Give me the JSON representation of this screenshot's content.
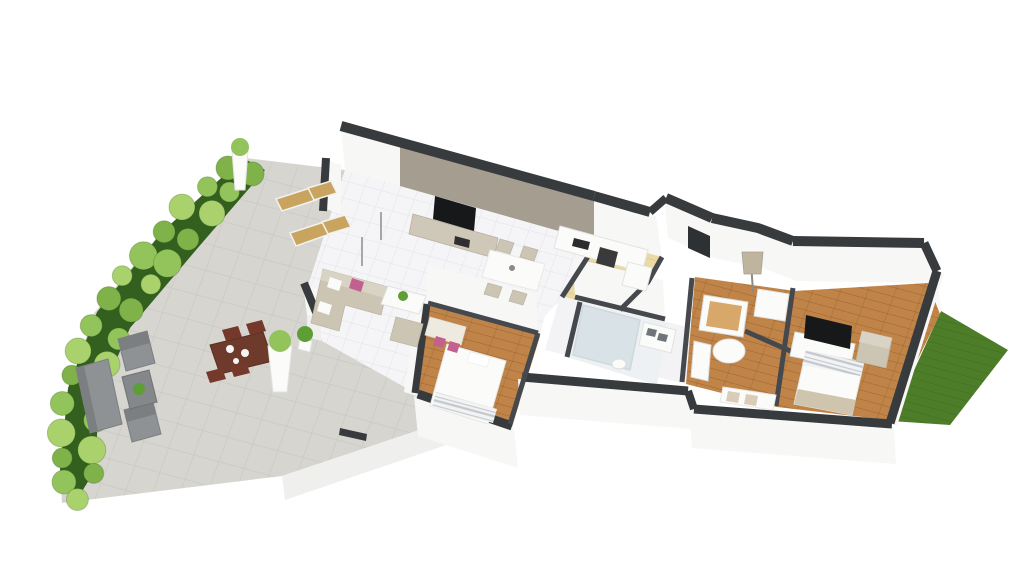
{
  "scene": {
    "title": "3D isometric floor plan rendering",
    "view": "axonometric top-down",
    "background": "#ffffff"
  },
  "colors": {
    "background": "#ffffff",
    "wall_cap": "#383b3e",
    "wall_cap_inner": "#45484c",
    "wall_face": "#f7f7f6",
    "edge_face": "#efefed",
    "accent_wall": "#a59d90",
    "console_taupe": "#cfc8b8",
    "tile_floor": "#f5f5f7",
    "tile_line": "#e3e3e9",
    "paving": "#d7d5d0",
    "paving_line": "#c8c6c1",
    "wood_floor": "#c08448",
    "wood_floor_light": "#ead9a4",
    "floor_hall": "#f3f3f5",
    "floor_bath": "#eef1f3",
    "hedge_grass": "#33601f",
    "bush_green_1": "#7fb249",
    "bush_green_2": "#93c35b",
    "bush_green_3": "#a9d16c",
    "lawn": "#4d7d28",
    "plant_green": "#5d9e35",
    "sofa_beige": "#cdc5b4",
    "sofa_back": "#d9d3c5",
    "pillow_pink": "#c2618f",
    "furniture_white": "#fbfbfa",
    "furniture_stroke": "#e2e2e0",
    "outdoor_gray": "#8f9295",
    "outdoor_gray_dark": "#7c7f82",
    "outdoor_table_brown": "#6e3a2b",
    "outdoor_chair_brown": "#74392a",
    "lounger_wood": "#c9a45f",
    "tv_black": "#17181a",
    "appliance_dark": "#3a3a3c",
    "crib_wood": "#d8a86a",
    "glass": "#b9cdd6",
    "stripe_gray": "#c4c8cd",
    "pot_dark": "#3b3b39"
  },
  "rooms": [
    {
      "id": "living-room",
      "label": "Living room",
      "floor": "white-tile",
      "furniture": [
        "corner-sofa",
        "pink-cushions",
        "coffee-table",
        "potted-plant",
        "tv-accent-wall",
        "flat-tv",
        "media-console",
        "dining-table",
        "dining-chairs"
      ]
    },
    {
      "id": "kitchen",
      "label": "Kitchen",
      "floor": "light-wood",
      "furniture": [
        "kitchen-counter",
        "oven",
        "cooktop",
        "tall-cabinet"
      ]
    },
    {
      "id": "hallway",
      "label": "Hallway",
      "floor": "white"
    },
    {
      "id": "bedroom",
      "label": "Bedroom",
      "floor": "wood",
      "furniture": [
        "double-bed",
        "striped-blanket",
        "desk",
        "pink-desk-chairs",
        "armchair"
      ]
    },
    {
      "id": "bathroom",
      "label": "Bathroom",
      "floor": "white",
      "furniture": [
        "walk-in-shower",
        "double-vanity",
        "toilet"
      ]
    },
    {
      "id": "nursery",
      "label": "Nursery",
      "floor": "wood",
      "furniture": [
        "crib",
        "dresser",
        "bassinet",
        "storage-bench",
        "radiator",
        "floor-lamp"
      ]
    },
    {
      "id": "master-bedroom",
      "label": "Master bedroom",
      "floor": "wood",
      "furniture": [
        "double-bed",
        "tv-dresser",
        "flat-tv",
        "armchair"
      ]
    }
  ],
  "outdoor": {
    "terrace": {
      "label": "Terrace",
      "surface": "stone-paving",
      "furniture": [
        "sun-lounger",
        "sun-lounger",
        "outdoor-sofa",
        "outdoor-armchair",
        "outdoor-armchair",
        "outdoor-coffee-table",
        "outdoor-dining-table",
        "outdoor-dining-chairs",
        "white-planter",
        "white-planter",
        "potted-plant"
      ]
    },
    "hedge": {
      "label": "Hedge border",
      "plants": "boxwood-bushes",
      "planters": [
        "white-vase-planter",
        "dark-pot"
      ]
    },
    "lawn": {
      "label": "Lawn",
      "surface": "grass"
    }
  }
}
